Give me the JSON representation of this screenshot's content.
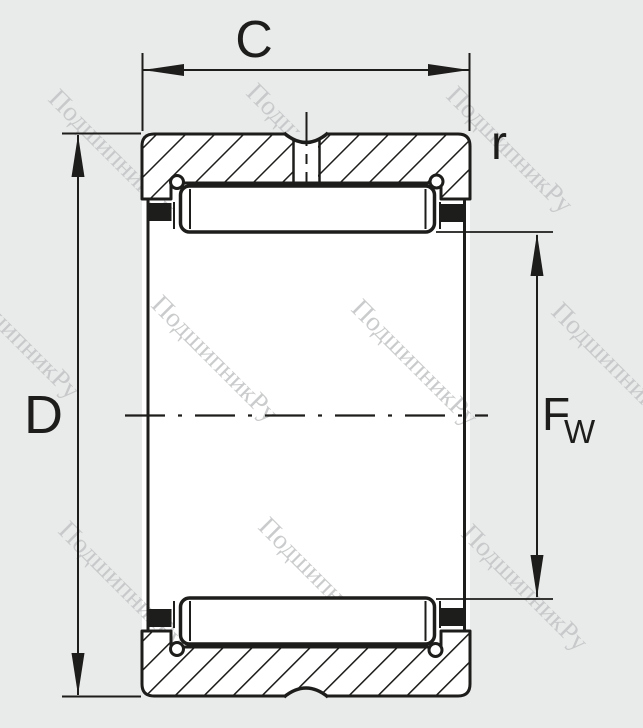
{
  "drawing": {
    "title": "needle-roller-bearing-cross-section",
    "labels": {
      "width_top": "C",
      "corner_radius": "r",
      "outer_diameter": "D",
      "raceway_diameter_main": "F",
      "raceway_diameter_sub": "W"
    },
    "watermark": {
      "text": "ПодшипникРу"
    },
    "colors": {
      "ink": "#1d1d1b",
      "background": "#e9eaea",
      "body_fill": "#ffffff",
      "watermark": "#c5c6c7"
    }
  }
}
